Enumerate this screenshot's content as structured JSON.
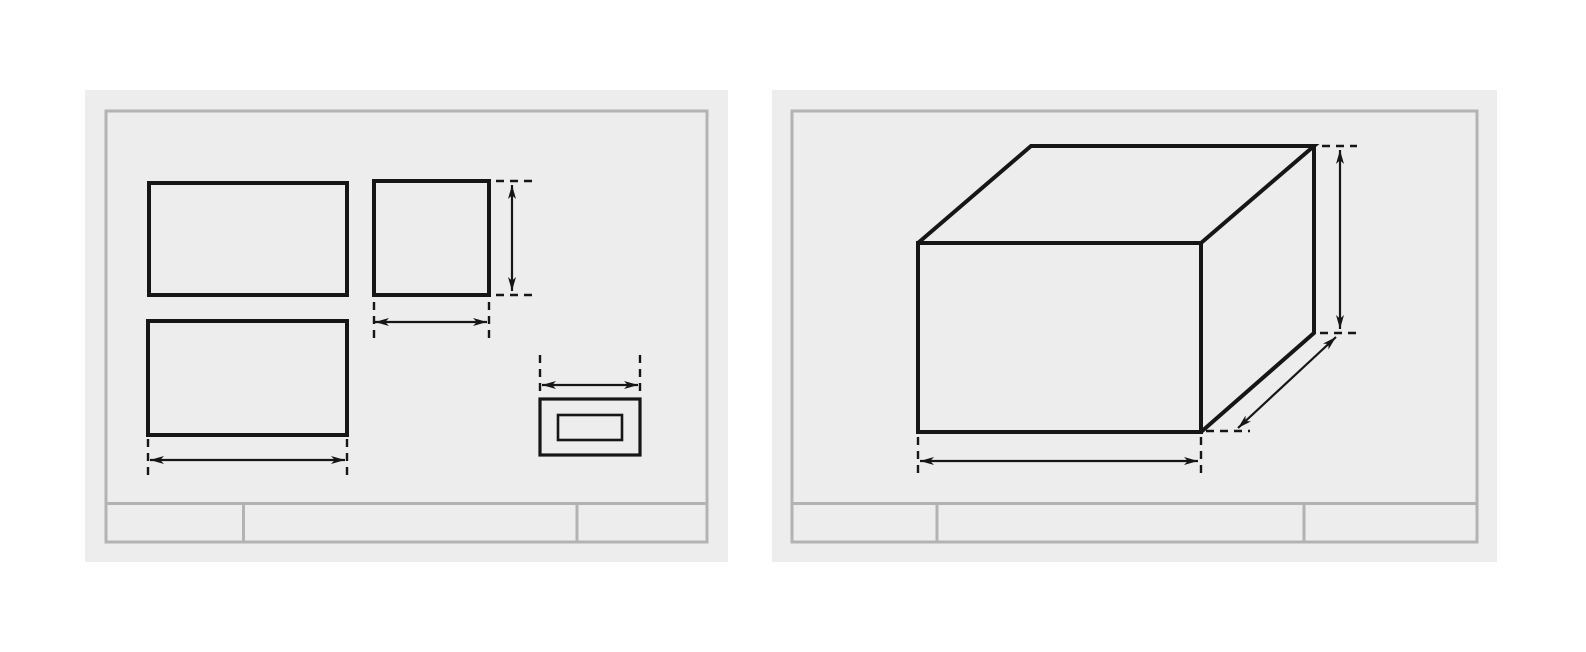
{
  "canvas": {
    "width": 1586,
    "height": 652,
    "background": "#ffffff"
  },
  "styles": {
    "sheet_background": "#ededed",
    "frame_color": "#b3b3b3",
    "ink_color": "#161616"
  },
  "sheets": [
    {
      "name": "orthographic-views-sheet",
      "panel": {
        "left": 85,
        "top": 90,
        "width": 643,
        "height": 472
      },
      "frame": {
        "x": 21,
        "y": 21,
        "w": 601,
        "h": 431
      },
      "title_block": {
        "line_y": 413.5,
        "dividers_x": [
          158.5,
          492
        ]
      },
      "elements": [
        {
          "name": "top-view-rect",
          "kind": "rect",
          "x": 64,
          "y": 93,
          "w": 198,
          "h": 112,
          "cls": "main"
        },
        {
          "name": "side-view-rect",
          "kind": "rect",
          "x": 289,
          "y": 91,
          "w": 115,
          "h": 114,
          "cls": "main"
        },
        {
          "name": "front-view-rect",
          "kind": "rect",
          "x": 63,
          "y": 231,
          "w": 199,
          "h": 114,
          "cls": "main"
        },
        {
          "name": "detail-view-outer-rect",
          "kind": "rect",
          "x": 455,
          "y": 309,
          "w": 100,
          "h": 56,
          "cls": "mid"
        },
        {
          "name": "detail-view-inner-rect",
          "kind": "rect",
          "x": 473,
          "y": 325,
          "w": 64,
          "h": 25,
          "cls": "thin"
        },
        {
          "name": "side-height-ext-top",
          "kind": "line",
          "x1": 411,
          "y1": 91,
          "x2": 452,
          "y2": 91,
          "cls": "dash"
        },
        {
          "name": "side-height-ext-bottom",
          "kind": "line",
          "x1": 411,
          "y1": 205,
          "x2": 452,
          "y2": 205,
          "cls": "dash"
        },
        {
          "name": "side-height-dim-arrow",
          "kind": "arrow",
          "x1": 427,
          "y1": 95,
          "x2": 427,
          "y2": 201,
          "cls": "dim"
        },
        {
          "name": "side-width-ext-left",
          "kind": "line",
          "x1": 289,
          "y1": 212,
          "x2": 289,
          "y2": 252,
          "cls": "dash"
        },
        {
          "name": "side-width-ext-right",
          "kind": "line",
          "x1": 404,
          "y1": 212,
          "x2": 404,
          "y2": 252,
          "cls": "dash"
        },
        {
          "name": "side-width-dim-arrow",
          "kind": "arrow",
          "x1": 290,
          "y1": 232,
          "x2": 402,
          "y2": 232,
          "cls": "dim"
        },
        {
          "name": "front-width-ext-left",
          "kind": "line",
          "x1": 63,
          "y1": 349,
          "x2": 63,
          "y2": 388,
          "cls": "dash"
        },
        {
          "name": "front-width-ext-right",
          "kind": "line",
          "x1": 262,
          "y1": 349,
          "x2": 262,
          "y2": 388,
          "cls": "dash"
        },
        {
          "name": "front-width-dim-arrow",
          "kind": "arrow",
          "x1": 65,
          "y1": 370,
          "x2": 260,
          "y2": 370,
          "cls": "dim"
        },
        {
          "name": "detail-width-ext-left",
          "kind": "line",
          "x1": 455,
          "y1": 265,
          "x2": 455,
          "y2": 307,
          "cls": "dash"
        },
        {
          "name": "detail-width-ext-right",
          "kind": "line",
          "x1": 555,
          "y1": 265,
          "x2": 555,
          "y2": 307,
          "cls": "dash"
        },
        {
          "name": "detail-width-dim-arrow",
          "kind": "arrow",
          "x1": 457,
          "y1": 295,
          "x2": 553,
          "y2": 295,
          "cls": "dim"
        }
      ]
    },
    {
      "name": "isometric-view-sheet",
      "panel": {
        "left": 772,
        "top": 90,
        "width": 725,
        "height": 472
      },
      "frame": {
        "x": 20,
        "y": 21,
        "w": 685,
        "h": 431
      },
      "title_block": {
        "line_y": 413.5,
        "dividers_x": [
          165,
          532
        ]
      },
      "elements": [
        {
          "name": "box-front-face",
          "kind": "rect",
          "x": 146,
          "y": 153,
          "w": 283,
          "h": 189,
          "cls": "main"
        },
        {
          "name": "box-top-face",
          "kind": "polyline",
          "points": "146,153 259,56 542,56 429,153",
          "cls": "main"
        },
        {
          "name": "box-right-face",
          "kind": "polyline",
          "points": "542,56 542,243 429,342",
          "cls": "main"
        },
        {
          "name": "height-ext-top",
          "kind": "line",
          "x1": 550,
          "y1": 56,
          "x2": 585,
          "y2": 56,
          "cls": "dash"
        },
        {
          "name": "height-ext-bottom",
          "kind": "line",
          "x1": 548,
          "y1": 243,
          "x2": 585,
          "y2": 243,
          "cls": "dash"
        },
        {
          "name": "height-dim-arrow",
          "kind": "arrow",
          "x1": 568,
          "y1": 60,
          "x2": 568,
          "y2": 239,
          "cls": "dim"
        },
        {
          "name": "depth-ext-dash",
          "kind": "line",
          "x1": 434,
          "y1": 341,
          "x2": 478,
          "y2": 341,
          "cls": "dash"
        },
        {
          "name": "depth-dim-arrow",
          "kind": "arrow",
          "x1": 564,
          "y1": 247,
          "x2": 466,
          "y2": 338,
          "cls": "dim"
        },
        {
          "name": "width-ext-left",
          "kind": "line",
          "x1": 146,
          "y1": 347,
          "x2": 146,
          "y2": 387,
          "cls": "dash"
        },
        {
          "name": "width-ext-right",
          "kind": "line",
          "x1": 429,
          "y1": 347,
          "x2": 429,
          "y2": 387,
          "cls": "dash"
        },
        {
          "name": "width-dim-arrow",
          "kind": "arrow",
          "x1": 148,
          "y1": 371,
          "x2": 426,
          "y2": 371,
          "cls": "dim"
        }
      ]
    }
  ]
}
